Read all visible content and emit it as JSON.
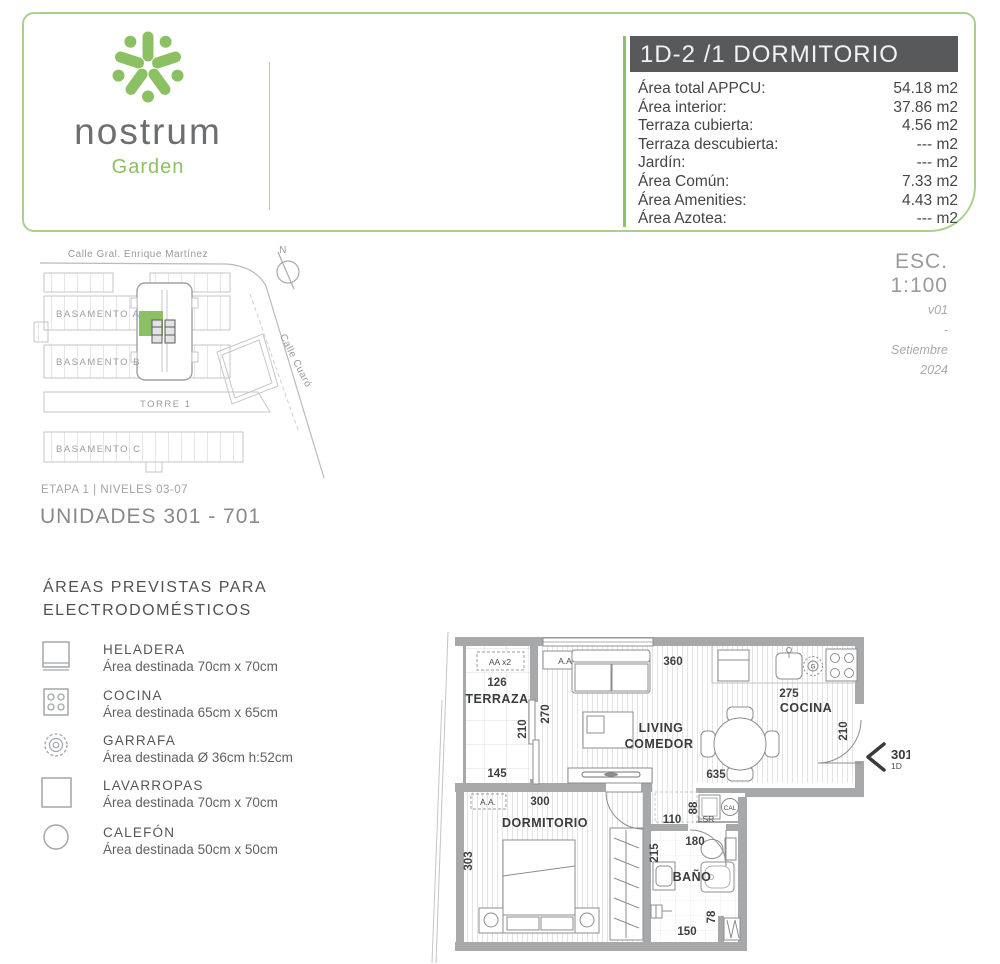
{
  "logo": {
    "brand": "nostrum",
    "sub": "Garden"
  },
  "header": {
    "title": "1D-2 /1 DORMITORIO",
    "areas": [
      {
        "label": "Área total APPCU:",
        "value": "54.18 m2"
      },
      {
        "label": "Área interior:",
        "value": "37.86 m2"
      },
      {
        "label": "Terraza cubierta:",
        "value": "4.56 m2"
      },
      {
        "label": "Terraza descubierta:",
        "value": "--- m2"
      },
      {
        "label": "Jardín:",
        "value": "--- m2"
      },
      {
        "label": "Área Común:",
        "value": "7.33 m2"
      },
      {
        "label": "Área Amenities:",
        "value": "4.43 m2"
      },
      {
        "label": "Área Azotea:",
        "value": "--- m2"
      }
    ]
  },
  "siteplan": {
    "street_top": "Calle Gral. Enrique Martínez",
    "street_side": "Calle Cuaró",
    "north": "N",
    "basamento_a": "BASAMENTO A",
    "basamento_b": "BASAMENTO B",
    "torre": "TORRE 1",
    "basamento_c": "BASAMENTO C"
  },
  "scaleblock": {
    "esc": "ESC.",
    "ratio": "1:100",
    "version": "v01",
    "sep": "-",
    "month": "Setiembre",
    "year": "2024"
  },
  "stage": {
    "etapa": "ETAPA 1  |  NIVELES 03-07",
    "unidades": "UNIDADES 301 - 701"
  },
  "legend": {
    "title1": "ÁREAS PREVISTAS PARA",
    "title2": "ELECTRODOMÉSTICOS",
    "items": [
      {
        "name": "HELADERA",
        "desc": "Área destinada 70cm x 70cm"
      },
      {
        "name": "COCINA",
        "desc": "Área destinada 65cm x 65cm"
      },
      {
        "name": "GARRAFA",
        "desc": "Área destinada Ø 36cm h:52cm"
      },
      {
        "name": "LAVARROPAS",
        "desc": "Área destinada 70cm x 70cm"
      },
      {
        "name": "CALEFÓN",
        "desc": "Área destinada 50cm x 50cm"
      }
    ]
  },
  "floorplan": {
    "rooms": {
      "terraza": "TERRAZA",
      "living_l1": "LIVING",
      "living_l2": "COMEDOR",
      "cocina": "COCINA",
      "dormitorio": "DORMITORIO",
      "bano": "BAÑO"
    },
    "dims": {
      "d360": "360",
      "d126": "126",
      "d210t": "210",
      "d145": "145",
      "d270": "270",
      "d635": "635",
      "d275": "275",
      "d210k": "210",
      "d300": "300",
      "d303": "303",
      "d110": "110",
      "d88": "88",
      "d180": "180",
      "d215": "215",
      "d78": "78",
      "d150": "150"
    },
    "labels": {
      "aax2": "AA x2",
      "aa_living": "A.A",
      "aa_dorm": "A.A.",
      "cal": "CAL",
      "lsr": "LSR",
      "g": "G",
      "marker": "301-701",
      "marker_sub": "1D"
    }
  },
  "colors": {
    "green": "#8cc163",
    "dark_bar": "#58595b",
    "wall_gray": "#a7a8aa"
  }
}
